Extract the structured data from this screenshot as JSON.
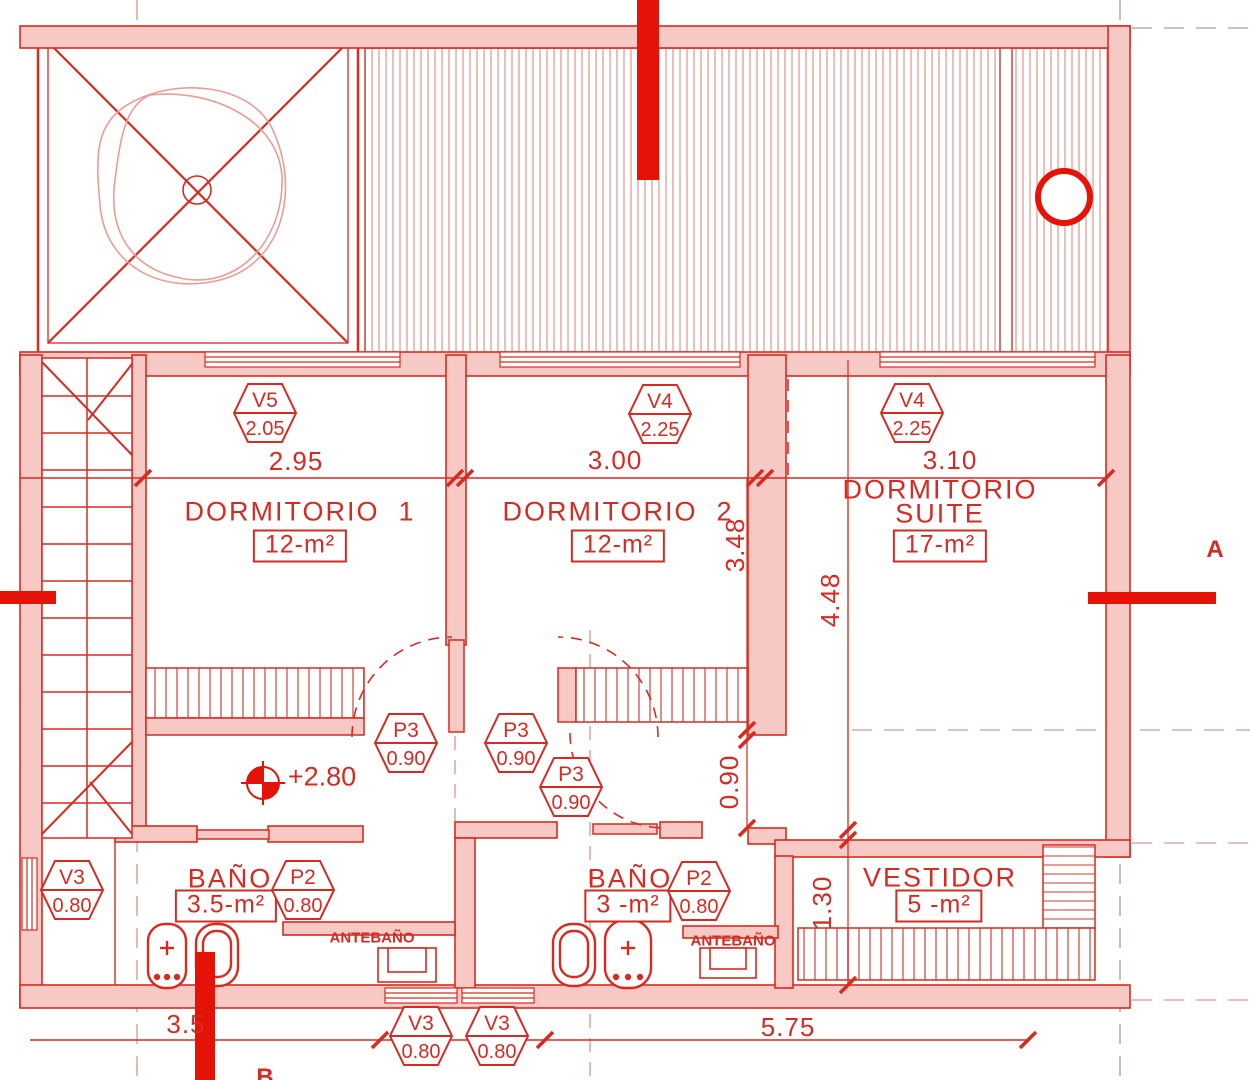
{
  "colors": {
    "line_red": "#d92a20",
    "wall_fill": "#f7c9c5",
    "hatch_red": "#e5968f",
    "section_red": "#e51208",
    "centerline_gray": "#b8aeac",
    "centerline_pink": "#dfaaa5"
  },
  "rooms": [
    {
      "label": "DORMITORIO  1",
      "area": "12-m²"
    },
    {
      "label": "DORMITORIO  2",
      "area": "12-m²"
    },
    {
      "label_line1": "DORMITORIO",
      "label_line2": "SUITE",
      "area": "17-m²"
    },
    {
      "label": "BAÑO",
      "area": "3.5-m²"
    },
    {
      "label": "BAÑO",
      "area": "3 -m²"
    },
    {
      "label": "VESTIDOR",
      "area": "5 -m²"
    },
    {
      "label": "ANTEBAÑO"
    },
    {
      "label": "ANTEBAÑO"
    }
  ],
  "tags": [
    {
      "code": "V5",
      "size": "2.05"
    },
    {
      "code": "V4",
      "size": "2.25"
    },
    {
      "code": "V4",
      "size": "2.25"
    },
    {
      "code": "P3",
      "size": "0.90"
    },
    {
      "code": "P3",
      "size": "0.90"
    },
    {
      "code": "P3",
      "size": "0.90"
    },
    {
      "code": "P2",
      "size": "0.80"
    },
    {
      "code": "P2",
      "size": "0.80"
    },
    {
      "code": "V3",
      "size": "0.80"
    },
    {
      "code": "V3",
      "size": "0.80"
    },
    {
      "code": "V3",
      "size": "0.80"
    }
  ],
  "dimensions": {
    "width_dorm1": "2.95",
    "width_dorm2": "3.00",
    "width_suite": "3.10",
    "depth_dorm2": "3.48",
    "depth_suite": "4.48",
    "door_offset": "0.90",
    "vestidor_depth": "1.30",
    "bottom_left": "3.5",
    "bottom_right": "5.75"
  },
  "annotations": {
    "level": "+2.80",
    "section_marker_a": "A",
    "section_marker_b": "B"
  }
}
